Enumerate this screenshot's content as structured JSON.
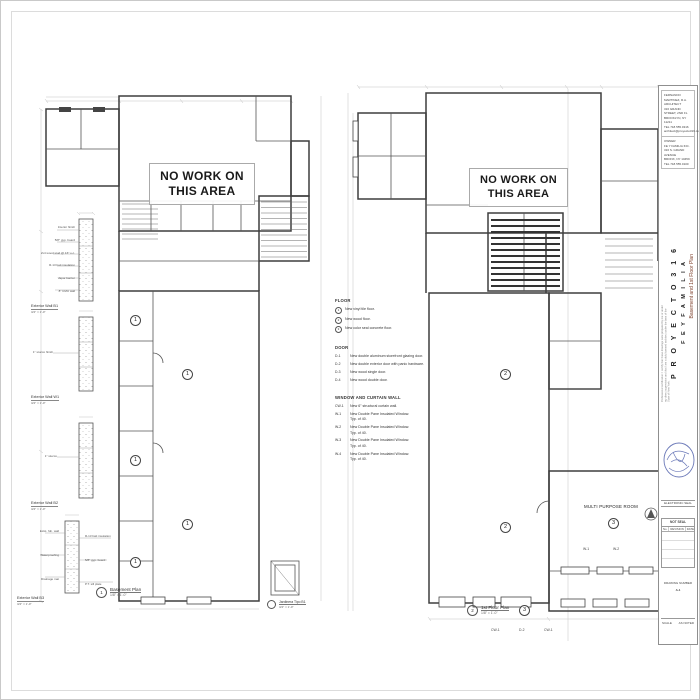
{
  "labels": {
    "no_work": {
      "line1": "NO WORK ON",
      "line2": "THIS AREA"
    }
  },
  "plans": {
    "left": {
      "title": "Basement Plan",
      "scale": "1/8\" = 1'-0\"",
      "title_num": "1",
      "keynotes": [
        "1",
        "1",
        "1",
        "1",
        "1"
      ],
      "jardinera": {
        "title": "Jardinera Tipo B1",
        "scale": "3/4\" = 1'-0\""
      }
    },
    "right": {
      "title": "1st Floor Plan",
      "scale": "1/8\" = 1'-0\"",
      "title_num": "2",
      "room_label": "MULTI PURPOSE ROOM",
      "keynotes": [
        "2",
        "2",
        "3",
        "3"
      ],
      "tags": [
        "CW-1",
        "D-2",
        "CW-1",
        "W-1",
        "W-2"
      ]
    }
  },
  "notes": {
    "floor": {
      "title": "FLOOR",
      "items": [
        {
          "code": "1",
          "text": "New vinyl tile floor."
        },
        {
          "code": "2",
          "text": "New wood floor."
        },
        {
          "code": "3",
          "text": "New color seal concrete floor."
        }
      ]
    },
    "door": {
      "title": "DOOR",
      "items": [
        {
          "code": "D-1",
          "text": "New double aluminum storefront glazing door."
        },
        {
          "code": "D-2",
          "text": "New double exterior door with panic hardware."
        },
        {
          "code": "D-3",
          "text": "New wood single door."
        },
        {
          "code": "D-4",
          "text": "New wood double door."
        }
      ]
    },
    "window": {
      "title": "WINDOW AND CURTAIN WALL",
      "items": [
        {
          "code": "CW-1",
          "text": "New 6\" structural curtain wall.",
          "sub": ""
        },
        {
          "code": "W-1",
          "text": "New Double Pane Insulated Window.",
          "sub": "Typ. of 40."
        },
        {
          "code": "W-2",
          "text": "New Double Pane Insulated Window.",
          "sub": "Typ. of 40."
        },
        {
          "code": "W-3",
          "text": "New Double Pane Insulated Window.",
          "sub": "Typ. of 40."
        },
        {
          "code": "W-4",
          "text": "New Double Pane Insulated Window.",
          "sub": "Typ. of 40."
        }
      ]
    }
  },
  "details": [
    {
      "title": "Exterior Wall B1",
      "scale": "3/4\" = 1'-0\"",
      "labels": [
        "Interior finish",
        "5/8\" gyp. board",
        "2x4 wood stud @ 16\" o.c.",
        "R-13 batt insulation",
        "Vapor barrier",
        "8\" CMU wall"
      ]
    },
    {
      "title": "Exterior Wall W1",
      "scale": "3/4\" = 1'-0\"",
      "labels": [
        "1\" stucco finish"
      ]
    },
    {
      "title": "Exterior Wall B2",
      "scale": "3/4\" = 1'-0\"",
      "labels": [
        "1\" stucco"
      ]
    },
    {
      "title": "Exterior Wall B3",
      "scale": "3/4\" = 1'-0\"",
      "labels": [
        "Exist. fdn. wall",
        "Waterproofing",
        "Drainage mat"
      ],
      "labels_right": [
        "R-13 batt insulation",
        "5/8\" gyp. board",
        "P.T. sill plate"
      ]
    }
  ],
  "titleblock": {
    "architect": {
      "l0": "FERNANDO MARTINEZ, R.A.",
      "l1": "ARCHITECT",
      "l2": "316 GRAND STREET, 2ND FL",
      "l3": "BROOKLYN, NY 11211",
      "l4": "TEL 718.555.0316",
      "l5": "architect@proyecto316.com"
    },
    "owner": {
      "l0": "OWNER",
      "l1": "FE Y FAMILIA INC.",
      "l2": "316 S. GRAND AVENUE",
      "l3": "BRONX, NY 10459",
      "l4": "TEL 718.555.0100"
    },
    "project": "P R O Y E C T O   3 1 6",
    "client": "F E   Y   F A M I L I A",
    "sheet_title": "Basement and 1st Floor Plan",
    "cert_note": "Professional certification: I certify that these drawings were prepared by me or under my direct supervision and that I am a duly licensed architect under the laws of the State of New York.",
    "seal_label": "ELECTRONIC SEAL",
    "rev_header": "NOT SEAL",
    "rev_cols": {
      "no": "No.",
      "revision": "REVISION",
      "date": "DATE"
    },
    "drawing_number_label": "DRAWING NUMBER",
    "drawing_number": "A-1",
    "scale_label": "SCALE",
    "scale_value": "AS NOTED"
  }
}
